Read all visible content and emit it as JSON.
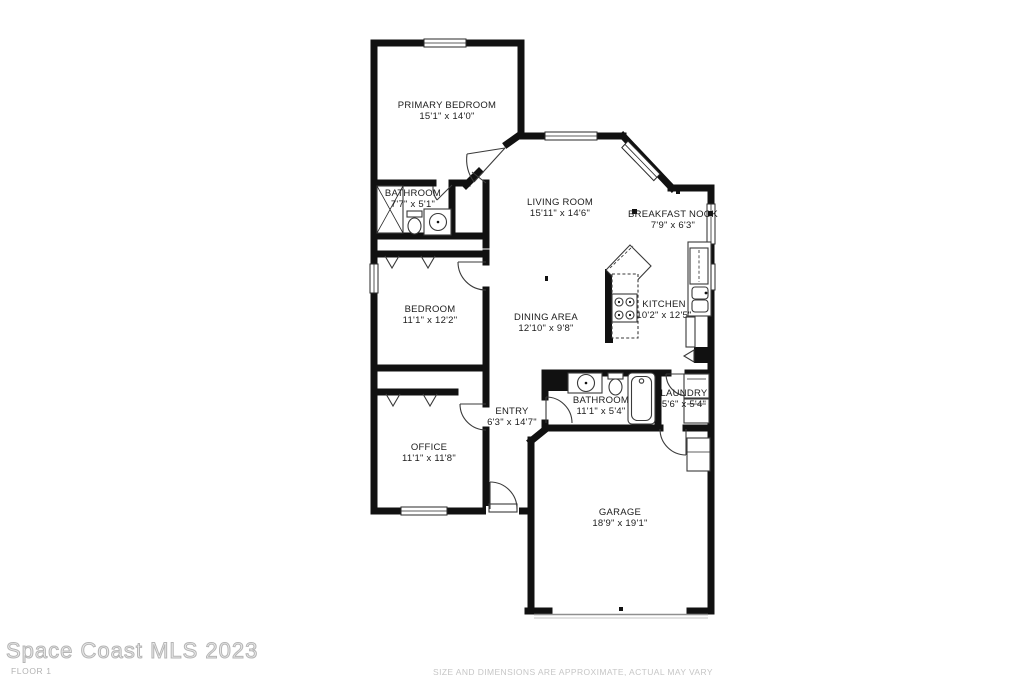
{
  "branding": {
    "watermark": "Space Coast MLS 2023",
    "floor_label": "FLOOR 1",
    "disclaimer": "SIZE AND DIMENSIONS ARE APPROXIMATE, ACTUAL MAY VARY"
  },
  "colors": {
    "wall": "#111111",
    "text": "#1c1c1c",
    "watermark": "#b5b5b5",
    "muted": "#c6c6c6",
    "background": "#ffffff"
  },
  "rooms": [
    {
      "id": "primary-bedroom",
      "name": "PRIMARY BEDROOM",
      "dims": "15'1\" x 14'0\""
    },
    {
      "id": "bathroom-primary",
      "name": "BATHROOM",
      "dims": "7'7\" x 5'1\""
    },
    {
      "id": "living-room",
      "name": "LIVING ROOM",
      "dims": "15'11\" x 14'6\""
    },
    {
      "id": "breakfast-nook",
      "name": "BREAKFAST NOOK",
      "dims": "7'9\" x 6'3\""
    },
    {
      "id": "bedroom",
      "name": "BEDROOM",
      "dims": "11'1\" x 12'2\""
    },
    {
      "id": "dining-area",
      "name": "DINING AREA",
      "dims": "12'10\" x 9'8\""
    },
    {
      "id": "kitchen",
      "name": "KITCHEN",
      "dims": "10'2\" x 12'5\""
    },
    {
      "id": "entry",
      "name": "ENTRY",
      "dims": "6'3\" x 14'7\""
    },
    {
      "id": "bathroom-2",
      "name": "BATHROOM",
      "dims": "11'1\" x 5'4\""
    },
    {
      "id": "laundry",
      "name": "LAUNDRY",
      "dims": "5'6\" x 5'4\""
    },
    {
      "id": "office",
      "name": "OFFICE",
      "dims": "11'1\" x 11'8\""
    },
    {
      "id": "garage",
      "name": "GARAGE",
      "dims": "18'9\" x 19'1\""
    }
  ],
  "fixtures": [
    "shower",
    "toilet",
    "sink-vanity",
    "bathtub",
    "range-stove",
    "refrigerator",
    "kitchen-sink",
    "dishwasher",
    "pantry-bifold-door",
    "washer",
    "dryer",
    "water-heater",
    "closet-hangers",
    "garage-door",
    "front-door",
    "window",
    "interior-door"
  ]
}
